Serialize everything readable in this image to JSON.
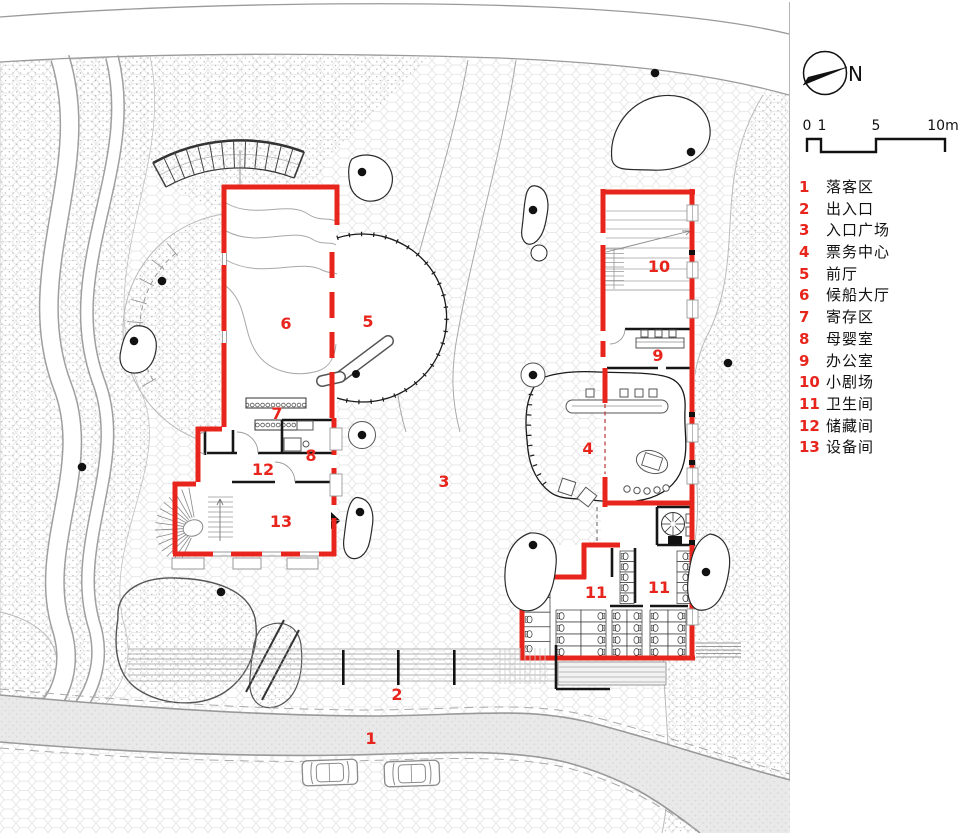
{
  "colors": {
    "wall_red": "#e8251c",
    "label_red": "#e8251c",
    "ink": "#1a1a1a",
    "line_gray": "#999999",
    "pave_line": "#e0e0e0",
    "stipple_dot": "#bdbdbd",
    "road_fill": "#e9e9e9"
  },
  "north_arrow": {
    "label": "N"
  },
  "scale_bar": {
    "labels": [
      "0",
      "1",
      "5",
      "10m"
    ]
  },
  "legend": {
    "items": [
      {
        "num": "1",
        "label": "落客区"
      },
      {
        "num": "2",
        "label": "出入口"
      },
      {
        "num": "3",
        "label": "入口广场"
      },
      {
        "num": "4",
        "label": "票务中心"
      },
      {
        "num": "5",
        "label": "前厅"
      },
      {
        "num": "6",
        "label": "候船大厅"
      },
      {
        "num": "7",
        "label": "寄存区"
      },
      {
        "num": "8",
        "label": "母婴室"
      },
      {
        "num": "9",
        "label": "办公室"
      },
      {
        "num": "10",
        "label": "小剧场"
      },
      {
        "num": "11",
        "label": "卫生间"
      },
      {
        "num": "12",
        "label": "储藏间"
      },
      {
        "num": "13",
        "label": "设备间"
      }
    ]
  },
  "plan_labels": [
    {
      "num": "1",
      "x": 371,
      "y": 744
    },
    {
      "num": "2",
      "x": 397,
      "y": 700
    },
    {
      "num": "3",
      "x": 444,
      "y": 487
    },
    {
      "num": "4",
      "x": 588,
      "y": 454
    },
    {
      "num": "5",
      "x": 368,
      "y": 327
    },
    {
      "num": "6",
      "x": 286,
      "y": 329
    },
    {
      "num": "7",
      "x": 277,
      "y": 419
    },
    {
      "num": "8",
      "x": 311,
      "y": 461
    },
    {
      "num": "9",
      "x": 658,
      "y": 361
    },
    {
      "num": "10",
      "x": 659,
      "y": 272
    },
    {
      "num": "11",
      "x": 596,
      "y": 598
    },
    {
      "num": "11",
      "x": 659,
      "y": 593
    },
    {
      "num": "12",
      "x": 263,
      "y": 475
    },
    {
      "num": "13",
      "x": 281,
      "y": 527
    }
  ]
}
